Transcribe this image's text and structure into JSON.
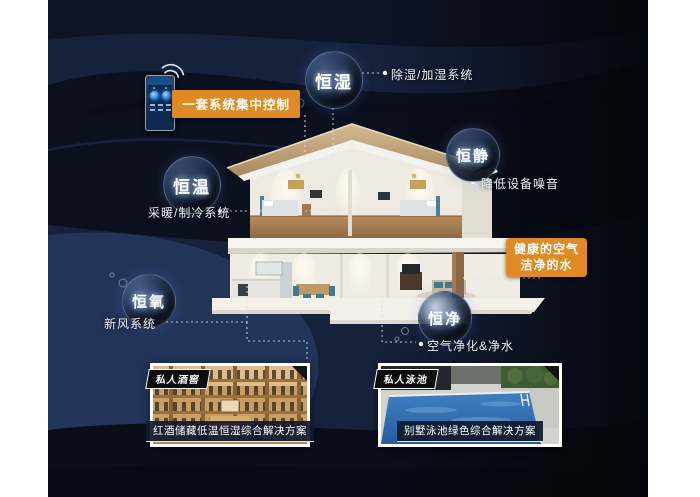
{
  "colors": {
    "accent_orange": "#e08a26",
    "background_navy": "#141e36",
    "navy_light": "#233459",
    "navy_dark": "#0b101f",
    "caption_bar": "#111b2e",
    "roof_tan": "#c9ab7d"
  },
  "control_badge": {
    "label": "一套系统集中控制"
  },
  "health_badge": {
    "line1": "健康的空气",
    "line2": "洁净的水"
  },
  "features": [
    {
      "bubble": "恒湿",
      "note": "除湿/加湿系统"
    },
    {
      "bubble": "恒静",
      "note": "降低设备噪音"
    },
    {
      "bubble": "恒温",
      "note": "采暖/制冷系统"
    },
    {
      "bubble": "恒氧",
      "note": "新风系统"
    },
    {
      "bubble": "恒净",
      "note": "空气净化&净水"
    }
  ],
  "cards": [
    {
      "tag": "私人酒窖",
      "caption": "红酒储藏低温恒湿综合解决方案"
    },
    {
      "tag": "私人泳池",
      "caption": "别墅泳池绿色综合解决方案"
    }
  ]
}
